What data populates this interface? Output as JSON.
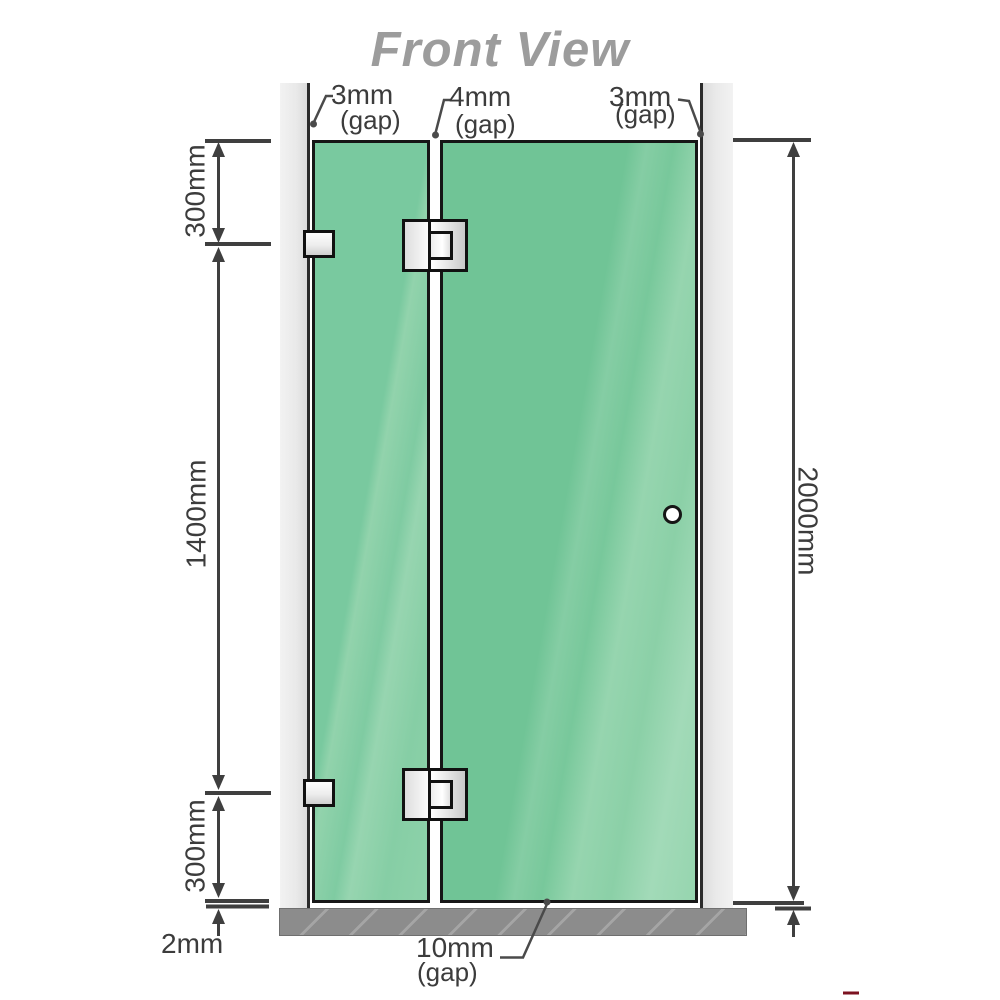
{
  "title": "Front View",
  "dimensions": {
    "top_left_gap": "3mm",
    "top_left_gap_suffix": "(gap)",
    "top_center_gap": "4mm",
    "top_center_gap_suffix": "(gap)",
    "top_right_gap": "3mm",
    "top_right_gap_suffix": "(gap)",
    "left_top_height": "300mm",
    "left_middle_height": "1400mm",
    "left_bottom_height": "300mm",
    "bottom_left_gap": "2mm",
    "right_total_height": "2000mm",
    "bottom_center_gap": "10mm",
    "bottom_center_gap_suffix": "(gap)"
  },
  "colors": {
    "glass_green": "#72c598",
    "glass_highlight": "#9ad7b2",
    "title_gray": "#9c9c9c",
    "dimension_gray": "#3f3f3f",
    "channel_gray": "#ececec",
    "hardware_border": "#111111",
    "floor_gray": "#8c8c8c",
    "watermark_red": "#7c1220"
  }
}
